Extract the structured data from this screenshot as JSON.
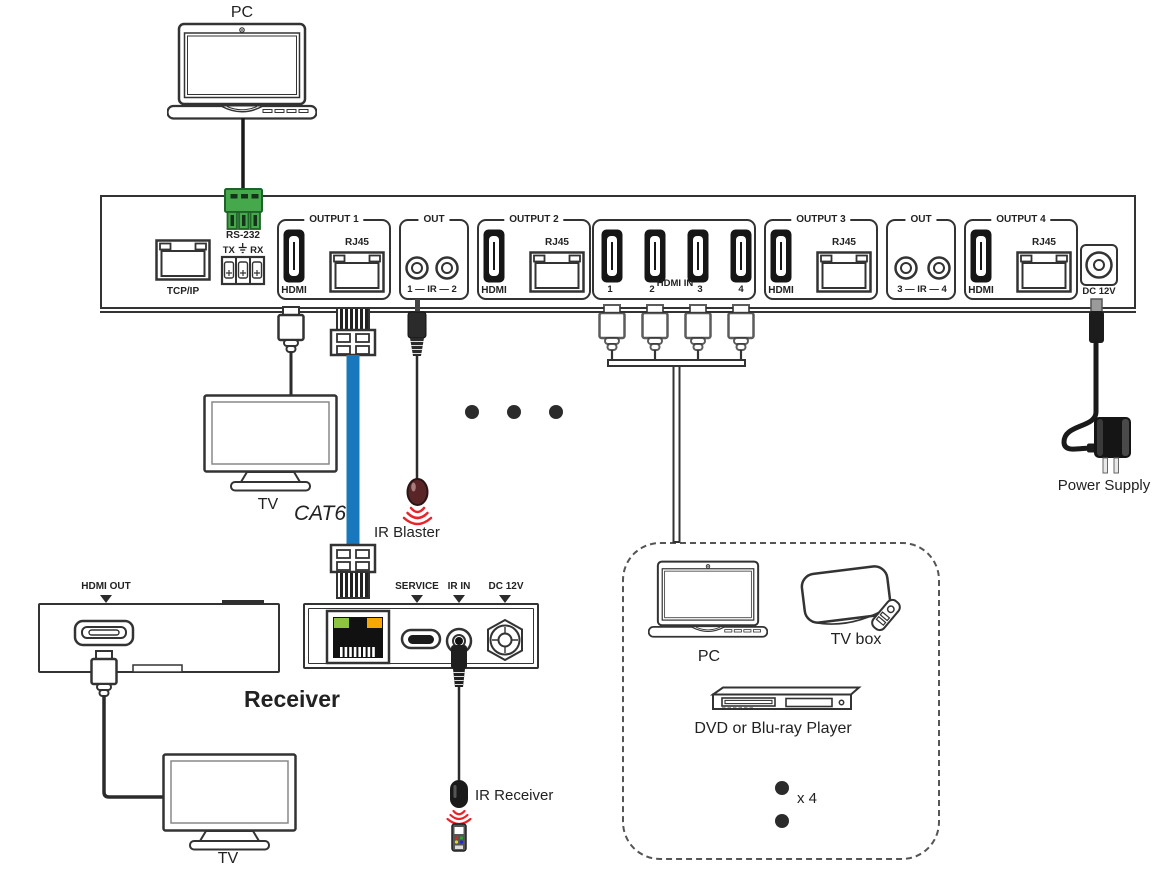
{
  "matrix": {
    "tcpip_label": "TCP/IP",
    "rs232_label": "RS-232",
    "rs232_tx": "TX",
    "rs232_rx": "RX",
    "output1": {
      "group_label": "OUTPUT 1",
      "hdmi_label": "HDMI",
      "rj45_label": "RJ45"
    },
    "ir_out_12": {
      "group_label": "OUT",
      "jack_label": "1 — IR — 2"
    },
    "output2": {
      "group_label": "OUTPUT 2",
      "hdmi_label": "HDMI",
      "rj45_label": "RJ45"
    },
    "hdmi_in": {
      "group_label": "HDMI IN",
      "port1": "1",
      "port2": "2",
      "port3": "3",
      "port4": "4"
    },
    "output3": {
      "group_label": "OUTPUT 3",
      "hdmi_label": "HDMI",
      "rj45_label": "RJ45"
    },
    "ir_out_34": {
      "group_label": "OUT",
      "jack_label": "3 — IR — 4"
    },
    "output4": {
      "group_label": "OUTPUT 4",
      "hdmi_label": "HDMI",
      "rj45_label": "RJ45"
    },
    "dc_label": "DC 12V"
  },
  "peripherals": {
    "pc_top_label": "PC",
    "tv_top_label": "TV",
    "cat6_label": "CAT6",
    "ir_blaster_label": "IR Blaster",
    "power_supply_label": "Power Supply",
    "ir_receiver_label": "IR Receiver",
    "tv_bottom_label": "TV"
  },
  "receiver": {
    "title": "Receiver",
    "hdmi_out_label": "HDMI OUT",
    "service_label": "SERVICE",
    "ir_in_label": "IR IN",
    "dc_label": "DC 12V"
  },
  "sources_box": {
    "pc_label": "PC",
    "tv_box_label": "TV box",
    "dvd_label": "DVD or Blu-ray Player",
    "multiplier_label": "x 4"
  },
  "colors": {
    "outline": "#333333",
    "cat6_blue": "#1878be",
    "phoenix_green": "#45a84b",
    "ir_red": "#e8232a",
    "ir_blaster_head": "#5a2527",
    "rj45_led_green": "#8cc63f",
    "rj45_led_orange": "#f7a800"
  }
}
